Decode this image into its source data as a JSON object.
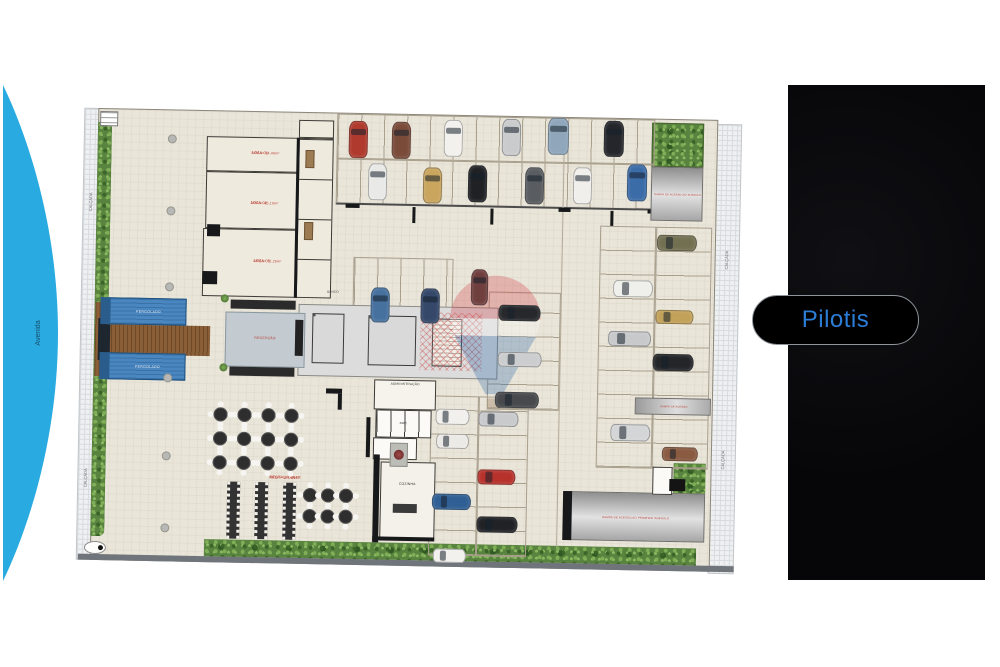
{
  "scene": {
    "street": {
      "label": "Avenida",
      "color": "#29abe2"
    },
    "panel_bg": "#0a0a0c",
    "button": {
      "label": "Pilotis",
      "color": "#2b7dd6"
    }
  },
  "plan": {
    "labels": {
      "calcada": "CALÇADA",
      "loja1_title": "LOJA 01",
      "loja1_area": "ÁREA= 34,40m²",
      "loja2_title": "LOJA 02",
      "loja2_area": "ÁREA= 45,10m²",
      "loja3_title": "LOJA 03",
      "loja3_area": "ÁREA= 72,25m²",
      "recepcao": "RECEPÇÃO",
      "banco": "BANCO",
      "administracao": "ADMINISTRAÇÃO",
      "bwc": "BWC",
      "cozinha": "COZINHA",
      "restaurante": "RESTAURANTE",
      "restaurante_area": "ÁREA= 187,36m²",
      "pergolado": "PERGOLADO",
      "rampa_subsolo": "RAMPA DE ACESSO AO SUBSOLO",
      "rampa_acesso": "RAMPA DE ACESSO",
      "rampa_primeiro": "RAMPA DE ACESSO AO PRIMEIRO SUBSOLO"
    },
    "watermark": {
      "name": "remax-balloon",
      "red": "#cf3339",
      "blue": "#1d5fa6"
    },
    "cars": [
      {
        "x": 265,
        "y": 10,
        "w": 19,
        "h": 37,
        "o": "v",
        "color": "#b03a2e"
      },
      {
        "x": 308,
        "y": 10,
        "w": 19,
        "h": 37,
        "o": "v",
        "color": "#7b4b3a"
      },
      {
        "x": 360,
        "y": 7,
        "w": 19,
        "h": 37,
        "o": "v",
        "color": "#f2f1ed"
      },
      {
        "x": 418,
        "y": 5,
        "w": 19,
        "h": 37,
        "o": "v",
        "color": "#c9cbcd"
      },
      {
        "x": 464,
        "y": 3,
        "w": 21,
        "h": 37,
        "o": "v",
        "color": "#8fa6bb"
      },
      {
        "x": 520,
        "y": 5,
        "w": 20,
        "h": 36,
        "o": "v",
        "color": "#24262b"
      },
      {
        "x": 285,
        "y": 52,
        "w": 19,
        "h": 37,
        "o": "v",
        "color": "#e9e9e7"
      },
      {
        "x": 340,
        "y": 55,
        "w": 19,
        "h": 36,
        "o": "v",
        "color": "#c9a55e"
      },
      {
        "x": 385,
        "y": 52,
        "w": 19,
        "h": 37,
        "o": "v",
        "color": "#1f2125"
      },
      {
        "x": 442,
        "y": 53,
        "w": 19,
        "h": 37,
        "o": "v",
        "color": "#595c60"
      },
      {
        "x": 490,
        "y": 52,
        "w": 19,
        "h": 37,
        "o": "v",
        "color": "#f0efeb"
      },
      {
        "x": 544,
        "y": 48,
        "w": 20,
        "h": 37,
        "o": "v",
        "color": "#3c6ca8"
      },
      {
        "x": 290,
        "y": 176,
        "w": 19,
        "h": 35,
        "o": "v",
        "color": "#46719f"
      },
      {
        "x": 340,
        "y": 176,
        "w": 19,
        "h": 35,
        "o": "v",
        "color": "#35486a"
      },
      {
        "x": 390,
        "y": 156,
        "w": 17,
        "h": 36,
        "o": "v",
        "color": "#6f3f3e"
      },
      {
        "x": 418,
        "y": 191,
        "w": 42,
        "h": 16,
        "o": "h",
        "color": "#26282c"
      },
      {
        "x": 418,
        "y": 238,
        "w": 44,
        "h": 15,
        "o": "h",
        "color": "#cccdcf"
      },
      {
        "x": 416,
        "y": 278,
        "w": 44,
        "h": 16,
        "o": "h",
        "color": "#47494d"
      },
      {
        "x": 575,
        "y": 118,
        "w": 40,
        "h": 16,
        "o": "h",
        "color": "#737052"
      },
      {
        "x": 532,
        "y": 164,
        "w": 40,
        "h": 17,
        "o": "h",
        "color": "#efefeb"
      },
      {
        "x": 575,
        "y": 193,
        "w": 38,
        "h": 14,
        "o": "h",
        "color": "#c2a159"
      },
      {
        "x": 528,
        "y": 215,
        "w": 43,
        "h": 15,
        "o": "h",
        "color": "#c7c9cb"
      },
      {
        "x": 573,
        "y": 237,
        "w": 41,
        "h": 17,
        "o": "h",
        "color": "#232529"
      },
      {
        "x": 532,
        "y": 308,
        "w": 40,
        "h": 17,
        "o": "h",
        "color": "#d4d5d6"
      },
      {
        "x": 584,
        "y": 330,
        "w": 36,
        "h": 14,
        "o": "h",
        "color": "#8a5a41"
      },
      {
        "x": 357,
        "y": 296,
        "w": 34,
        "h": 16,
        "o": "h",
        "color": "#f1f0ec"
      },
      {
        "x": 400,
        "y": 298,
        "w": 40,
        "h": 15,
        "o": "h",
        "color": "#c9cacc"
      },
      {
        "x": 358,
        "y": 321,
        "w": 33,
        "h": 15,
        "o": "h",
        "color": "#eceae6"
      },
      {
        "x": 400,
        "y": 356,
        "w": 38,
        "h": 15,
        "o": "h",
        "color": "#b8322c"
      },
      {
        "x": 355,
        "y": 381,
        "w": 39,
        "h": 16,
        "o": "h",
        "color": "#2f5f94"
      },
      {
        "x": 400,
        "y": 403,
        "w": 41,
        "h": 16,
        "o": "h",
        "color": "#202226"
      },
      {
        "x": 357,
        "y": 436,
        "w": 33,
        "h": 14,
        "o": "h",
        "color": "#f2f1ee"
      }
    ],
    "round_tables": [
      {
        "x": 135,
        "y": 299
      },
      {
        "x": 159,
        "y": 299
      },
      {
        "x": 183,
        "y": 299
      },
      {
        "x": 206,
        "y": 299
      },
      {
        "x": 135,
        "y": 323
      },
      {
        "x": 159,
        "y": 323
      },
      {
        "x": 183,
        "y": 323
      },
      {
        "x": 206,
        "y": 323
      },
      {
        "x": 135,
        "y": 347
      },
      {
        "x": 159,
        "y": 347
      },
      {
        "x": 183,
        "y": 347
      },
      {
        "x": 206,
        "y": 347
      },
      {
        "x": 226,
        "y": 378
      },
      {
        "x": 244,
        "y": 378
      },
      {
        "x": 262,
        "y": 378
      },
      {
        "x": 226,
        "y": 399
      },
      {
        "x": 244,
        "y": 399
      },
      {
        "x": 262,
        "y": 399
      }
    ],
    "long_tables": [
      {
        "x": 150,
        "y": 373
      },
      {
        "x": 178,
        "y": 373
      },
      {
        "x": 206,
        "y": 373
      }
    ],
    "columns": [
      {
        "x": 84,
        "y": 27
      },
      {
        "x": 84,
        "y": 99
      },
      {
        "x": 84,
        "y": 175
      },
      {
        "x": 84,
        "y": 266
      },
      {
        "x": 84,
        "y": 344
      },
      {
        "x": 84,
        "y": 416
      }
    ]
  }
}
